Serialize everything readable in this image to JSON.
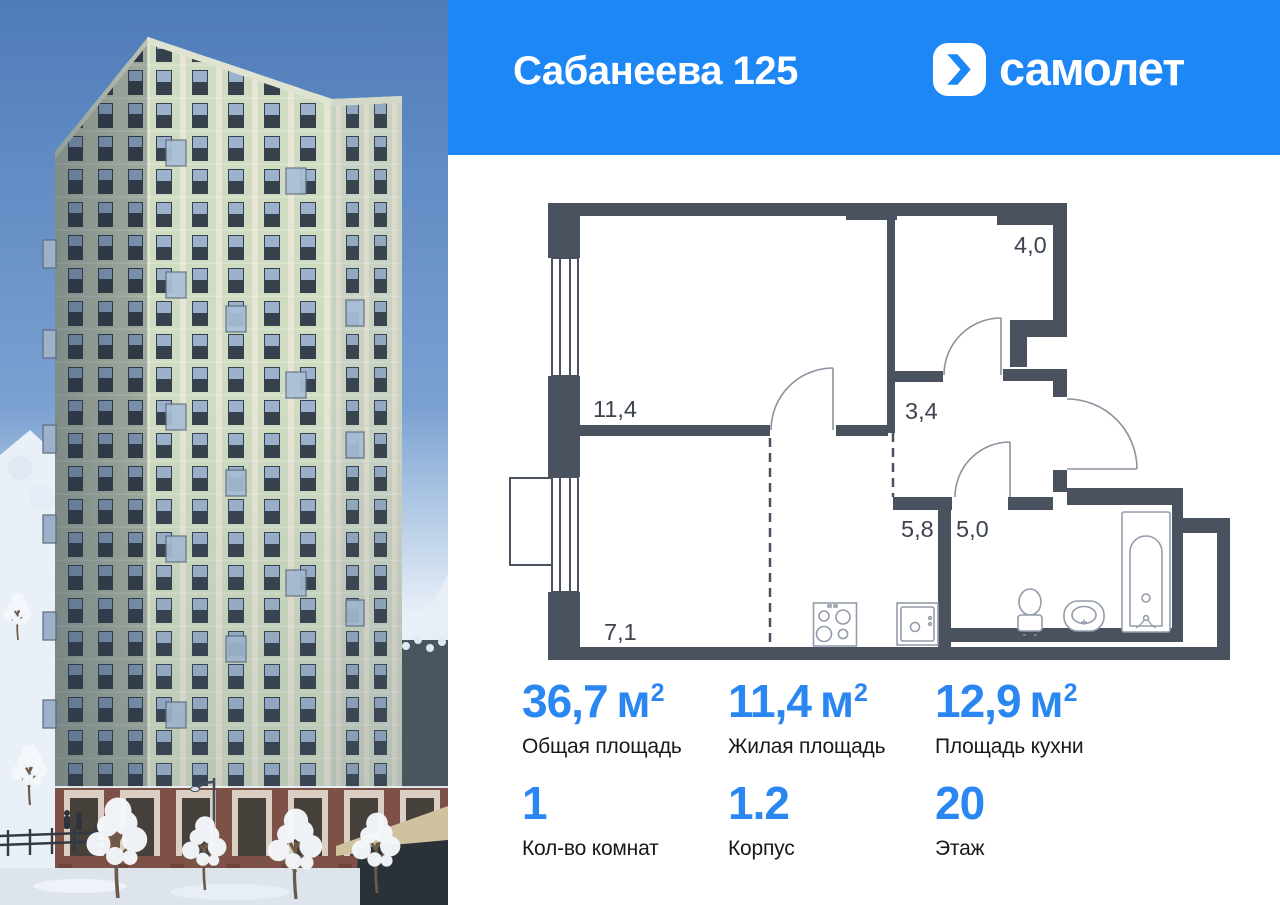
{
  "header": {
    "title": "Сабанеева 125",
    "brand": "самолет"
  },
  "floorplan": {
    "rooms": [
      {
        "name": "room-living",
        "area": "11,4"
      },
      {
        "name": "room-hall-upper",
        "area": "4,0"
      },
      {
        "name": "room-hall",
        "area": "3,4"
      },
      {
        "name": "room-kitchen-right",
        "area": "5,8"
      },
      {
        "name": "room-bathroom",
        "area": "5,0"
      },
      {
        "name": "room-kitchen-left",
        "area": "7,1"
      }
    ]
  },
  "stats": {
    "primary": [
      {
        "value": "36,7",
        "unit": "м",
        "sup": "2",
        "label": "Общая площадь"
      },
      {
        "value": "11,4",
        "unit": "м",
        "sup": "2",
        "label": "Жилая площадь"
      },
      {
        "value": "12,9",
        "unit": "м",
        "sup": "2",
        "label": "Площадь кухни"
      }
    ],
    "secondary": [
      {
        "value": "1",
        "label": "Кол-во комнат"
      },
      {
        "value": "1.2",
        "label": "Корпус"
      },
      {
        "value": "20",
        "label": "Этаж"
      }
    ]
  },
  "colors": {
    "accent": "#1e87f6",
    "stat_value": "#2a86f1",
    "plan_wall": "#4a5260",
    "plan_text": "#3d4450"
  }
}
